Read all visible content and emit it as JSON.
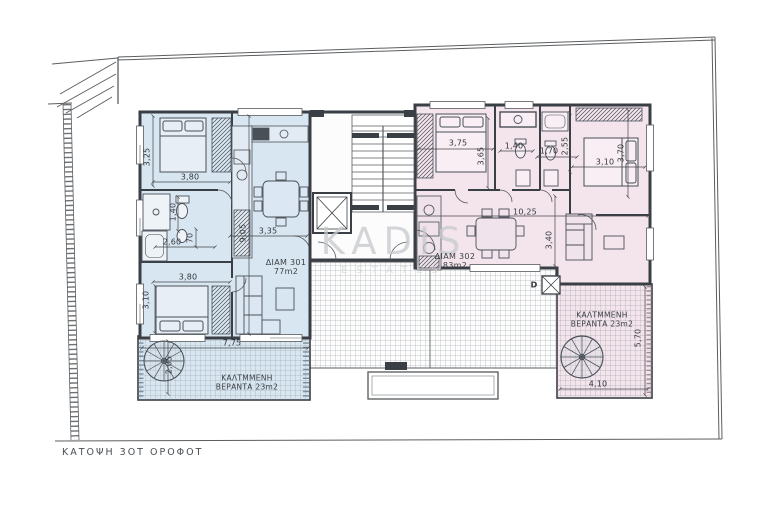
{
  "title": "ΚΑΤΟΨΗ 3ΟΤ ΟΡΟΦΟΤ",
  "watermark": {
    "brand": "KADIS",
    "sub": "ESTATES"
  },
  "apartments": {
    "apt301": {
      "name": "ΔΙΑΜ 301",
      "area": "77m2"
    },
    "apt302": {
      "name": "ΔΙΑΜ 302",
      "area": "83m2"
    }
  },
  "verandas": {
    "left": {
      "line1": "ΚΑΛΤΜΜΕΝΗ",
      "line2": "ΒΕΡΑΝΤΑ 23m2"
    },
    "right": {
      "line1": "ΚΑΛΤΜΜΕΝΗ",
      "line2": "ΒΕΡΑΝΤΑ 23m2"
    }
  },
  "door_label": "D",
  "colors": {
    "apt301_fill": "#d8e6f1",
    "apt302_fill": "#f4e5ed",
    "wall": "#3a3f45",
    "dimension_text": "#34383d",
    "watermark": "#c9cccf"
  },
  "dimensions": [
    {
      "text": "3,25",
      "x": 147,
      "y": 157,
      "rot": -90
    },
    {
      "text": "3,80",
      "x": 190,
      "y": 177,
      "rot": 0
    },
    {
      "text": "1,40",
      "x": 173,
      "y": 212,
      "rot": -90
    },
    {
      "text": "2,60",
      "x": 172,
      "y": 242,
      "rot": 0
    },
    {
      "text": "70",
      "x": 190,
      "y": 238,
      "rot": -90
    },
    {
      "text": "3,10",
      "x": 146,
      "y": 300,
      "rot": -90
    },
    {
      "text": "3,80",
      "x": 188,
      "y": 277,
      "rot": 0
    },
    {
      "text": "9,05",
      "x": 243,
      "y": 233,
      "rot": -90
    },
    {
      "text": "3,35",
      "x": 268,
      "y": 231,
      "rot": 0
    },
    {
      "text": "7,75",
      "x": 232,
      "y": 343,
      "rot": 0
    },
    {
      "text": "2,05",
      "x": 169,
      "y": 365,
      "rot": -90
    },
    {
      "text": "3,75",
      "x": 458,
      "y": 143,
      "rot": 0
    },
    {
      "text": "3,65",
      "x": 481,
      "y": 156,
      "rot": -90
    },
    {
      "text": "1,40",
      "x": 514,
      "y": 146,
      "rot": 0
    },
    {
      "text": "1,70",
      "x": 549,
      "y": 151,
      "rot": 0
    },
    {
      "text": "2,55",
      "x": 565,
      "y": 146,
      "rot": -90
    },
    {
      "text": "3,10",
      "x": 605,
      "y": 162,
      "rot": 0
    },
    {
      "text": "3,70",
      "x": 621,
      "y": 153,
      "rot": -90
    },
    {
      "text": "10,25",
      "x": 525,
      "y": 212,
      "rot": 0
    },
    {
      "text": "3,40",
      "x": 549,
      "y": 240,
      "rot": -90
    },
    {
      "text": "5,70",
      "x": 638,
      "y": 338,
      "rot": -90
    },
    {
      "text": "4,10",
      "x": 598,
      "y": 384,
      "rot": 0
    }
  ]
}
